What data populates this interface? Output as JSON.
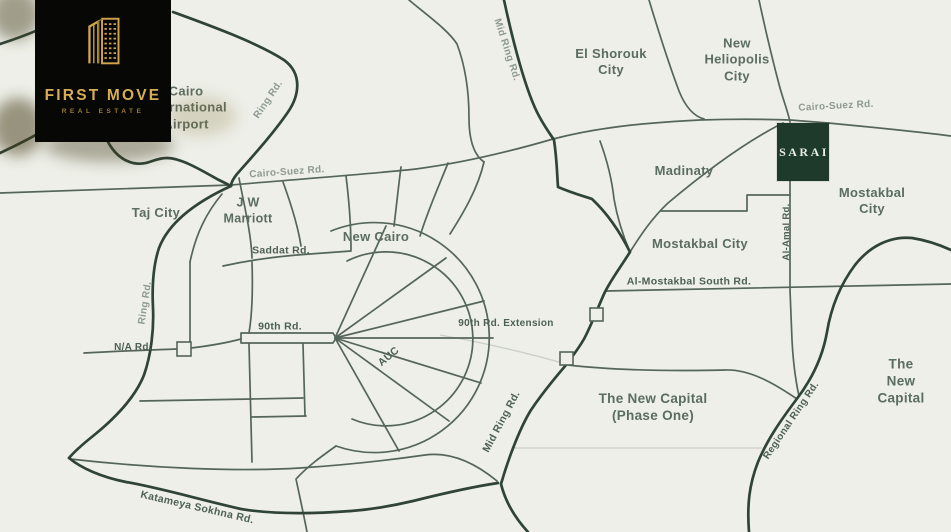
{
  "colors": {
    "background": "#edefe8",
    "road": "#55655a",
    "road_bold": "#2f4337",
    "road_faint": "#cbd0c5",
    "label_city": "#5b6c60",
    "label_road": "#4e6054",
    "label_road_light": "#8e9a8f",
    "marker_bg": "#1e3a2b",
    "marker_text": "#e9ece8",
    "logo_bg": "#070706",
    "logo_gold": "#d8ad52",
    "logo_gold_dim": "#9a7d35"
  },
  "logo": {
    "line1": "FIRST MOVE",
    "line2": "REAL ESTATE"
  },
  "marker": {
    "label": "SARAI"
  },
  "map_labels": [
    {
      "id": "cairo-international-airport",
      "text": "Cairo\nInternational\nAirport",
      "x": 186,
      "y": 108,
      "cls": "city"
    },
    {
      "id": "el-shorouk-city",
      "text": "El Shorouk\nCity",
      "x": 611,
      "y": 62,
      "cls": "city"
    },
    {
      "id": "new-heliopolis-city",
      "text": "New\nHeliopolis\nCity",
      "x": 737,
      "y": 60,
      "cls": "city"
    },
    {
      "id": "cairo-suez-rd-ne",
      "text": "Cairo-Suez Rd.",
      "x": 836,
      "y": 107,
      "rot": -3,
      "cls": "roadlight"
    },
    {
      "id": "madinaty",
      "text": "Madinaty",
      "x": 684,
      "y": 171,
      "cls": "city"
    },
    {
      "id": "mostakbal-city-e",
      "text": "Mostakbal City",
      "x": 872,
      "y": 201,
      "cls": "city"
    },
    {
      "id": "al-amal-rd",
      "text": "Al-Amal Rd.",
      "x": 787,
      "y": 232,
      "rot": -90,
      "cls": "road",
      "size": 9.5
    },
    {
      "id": "mostakbal-city-c",
      "text": "Mostakbal City",
      "x": 700,
      "y": 244,
      "cls": "city"
    },
    {
      "id": "al-mostakbal-south-rd",
      "text": "Al-Mostakbal South Rd.",
      "x": 689,
      "y": 282,
      "cls": "road"
    },
    {
      "id": "taj-city",
      "text": "Taj City",
      "x": 156,
      "y": 213,
      "cls": "city"
    },
    {
      "id": "jw-marriott",
      "text": "J W\nMarriott",
      "x": 248,
      "y": 211,
      "cls": "city",
      "size": 12.5
    },
    {
      "id": "cairo-suez-rd-w",
      "text": "Cairo-Suez Rd.",
      "x": 287,
      "y": 173,
      "rot": -4,
      "cls": "roadlight"
    },
    {
      "id": "ring-rd-n",
      "text": "Ring Rd.",
      "x": 269,
      "y": 100,
      "rot": -56,
      "cls": "roadlight"
    },
    {
      "id": "ring-rd-w",
      "text": "Ring Rd.",
      "x": 146,
      "y": 303,
      "rot": -81,
      "cls": "roadlight"
    },
    {
      "id": "saddat-rd",
      "text": "Saddat Rd.",
      "x": 281,
      "y": 251,
      "cls": "road"
    },
    {
      "id": "new-cairo",
      "text": "New Cairo",
      "x": 376,
      "y": 237,
      "cls": "city"
    },
    {
      "id": "rd-90",
      "text": "90th Rd.",
      "x": 280,
      "y": 327,
      "cls": "road"
    },
    {
      "id": "na-rd",
      "text": "N/A Rd.",
      "x": 133,
      "y": 348,
      "cls": "road",
      "size": 10
    },
    {
      "id": "rd-90-extension",
      "text": "90th Rd. Extension",
      "x": 506,
      "y": 324,
      "cls": "road",
      "size": 10
    },
    {
      "id": "auc",
      "text": "AUC",
      "x": 389,
      "y": 357,
      "rot": -40,
      "cls": "road"
    },
    {
      "id": "mid-ring-rd-n",
      "text": "Mid Ring Rd.",
      "x": 506,
      "y": 50,
      "rot": 72,
      "cls": "roadlight"
    },
    {
      "id": "mid-ring-rd-s",
      "text": "Mid Ring Rd.",
      "x": 502,
      "y": 422,
      "rot": -62,
      "cls": "road"
    },
    {
      "id": "the-new-capital-phase-one",
      "text": "The New Capital\n(Phase One)",
      "x": 653,
      "y": 408,
      "cls": "city",
      "size": 13.5
    },
    {
      "id": "the-new-capital-e",
      "text": "The New Capital",
      "x": 901,
      "y": 382,
      "cls": "city",
      "size": 13.5
    },
    {
      "id": "regional-ring-rd",
      "text": "Regional Ring Rd.",
      "x": 792,
      "y": 421,
      "rot": -56,
      "cls": "road",
      "size": 10
    },
    {
      "id": "katameya-sokhna-rd",
      "text": "Katameya Sokhna Rd.",
      "x": 197,
      "y": 508,
      "rot": 13,
      "cls": "road"
    }
  ]
}
